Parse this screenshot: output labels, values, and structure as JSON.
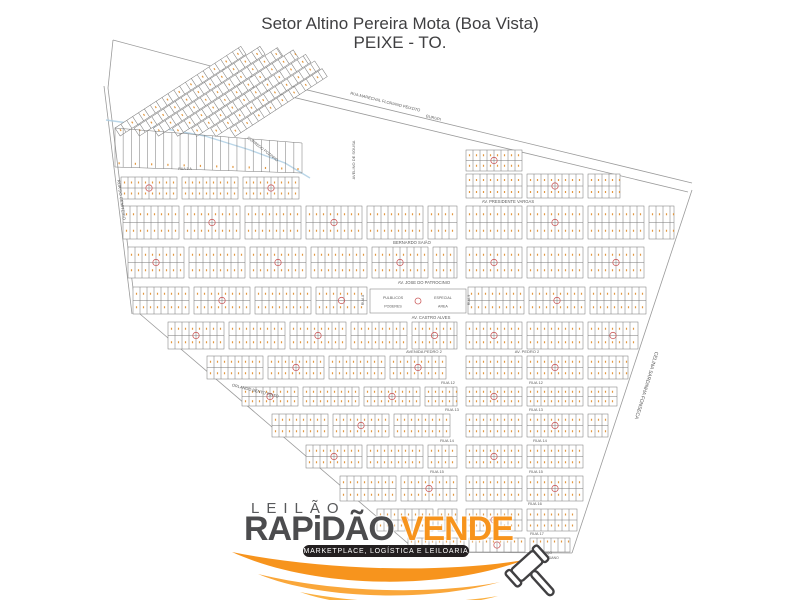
{
  "title": {
    "line1": "Setor Altino Pereira Mota (Boa Vista)",
    "line2": "PEIXE - TO."
  },
  "colors": {
    "brand_orange": "#f7941d",
    "brand_orange_light": "#faa73a",
    "brand_orange_lighter": "#fbb040",
    "brand_dark": "#4c4c4e",
    "pill_bg": "#231f20",
    "map_line": "#767676",
    "boundary_line": "#9a9a9a",
    "lot_number": "#e2973f",
    "block_circle": "#cc5f5f",
    "stream": "#aecfe4",
    "label_text": "#5a5a5a",
    "title_text": "#3f3f41"
  },
  "map": {
    "block_w": 56,
    "street_gap": 5,
    "boundary_lines": [
      [
        [
          113,
          40
        ],
        [
          233,
          72
        ]
      ],
      [
        [
          233,
          72
        ],
        [
          692,
          183
        ]
      ],
      [
        [
          238,
          84
        ],
        [
          688,
          192
        ]
      ],
      [
        [
          113,
          40
        ],
        [
          108,
          88
        ],
        [
          136,
          312
        ]
      ],
      [
        [
          104,
          86
        ],
        [
          132,
          314
        ]
      ],
      [
        [
          140,
          314
        ],
        [
          418,
          552
        ]
      ],
      [
        [
          418,
          552
        ],
        [
          572,
          553
        ]
      ],
      [
        [
          572,
          553
        ],
        [
          692,
          190
        ]
      ]
    ],
    "stream": [
      [
        106,
        120
      ],
      [
        150,
        126
      ],
      [
        205,
        136
      ],
      [
        250,
        150
      ],
      [
        285,
        163
      ],
      [
        310,
        178
      ]
    ],
    "rows": [
      {
        "y": 150,
        "h": 21,
        "spans": [
          [
            466,
            530
          ]
        ]
      },
      {
        "y": 174,
        "h": 24,
        "spans": [
          [
            466,
            620
          ]
        ]
      },
      {
        "y": 177,
        "h": 22,
        "spans": [
          [
            121,
            313
          ]
        ]
      },
      {
        "y": 206,
        "h": 33,
        "spans": [
          [
            123,
            457
          ],
          [
            466,
            674
          ]
        ]
      },
      {
        "y": 247,
        "h": 31,
        "spans": [
          [
            128,
            457
          ],
          [
            466,
            662
          ]
        ]
      },
      {
        "y": 287,
        "h": 27,
        "spans": [
          [
            133,
            367
          ],
          [
            468,
            650
          ]
        ]
      },
      {
        "y": 322,
        "h": 27,
        "spans": [
          [
            168,
            457
          ],
          [
            466,
            638
          ]
        ]
      },
      {
        "y": 356,
        "h": 23,
        "spans": [
          [
            207,
            457
          ],
          [
            466,
            628
          ]
        ]
      },
      {
        "y": 387,
        "h": 19,
        "spans": [
          [
            242,
            457
          ],
          [
            466,
            617
          ]
        ]
      },
      {
        "y": 414,
        "h": 23,
        "spans": [
          [
            272,
            457
          ],
          [
            466,
            608
          ]
        ]
      },
      {
        "y": 445,
        "h": 23,
        "spans": [
          [
            306,
            457
          ],
          [
            466,
            598
          ]
        ]
      },
      {
        "y": 476,
        "h": 25,
        "spans": [
          [
            340,
            457
          ],
          [
            466,
            587
          ]
        ]
      },
      {
        "y": 509,
        "h": 22,
        "spans": [
          [
            377,
            457
          ],
          [
            466,
            577
          ]
        ]
      },
      {
        "y": 538,
        "h": 14,
        "spans": [
          [
            408,
            570
          ]
        ]
      }
    ],
    "diagonal_grid": {
      "transform": "translate(115,128) rotate(-33)",
      "strip_h": 9.5,
      "strips": [
        [
          0,
          0,
          150
        ],
        [
          16,
          10.5,
          150
        ],
        [
          32,
          21,
          148
        ],
        [
          48,
          31.5,
          144
        ],
        [
          64,
          42,
          136
        ],
        [
          80,
          52.5,
          124
        ],
        [
          96,
          63,
          110
        ]
      ]
    },
    "comb": {
      "x1": 115,
      "x2": 302,
      "yt1": 128,
      "yt2": 143,
      "yb1": 167,
      "yb2": 173,
      "step": 8
    },
    "special_block": {
      "x": 370,
      "y": 289,
      "w": 96,
      "h": 24,
      "left_line1": "PULBLICOS",
      "left_line2": "PODERES",
      "right_line1": "ESPECIAL",
      "right_line2": "AREA"
    },
    "street_labels": [
      {
        "t": "RUA MARECHAL FLORIANO PEIXOTO",
        "x": 385,
        "y": 103,
        "r": 14,
        "s": 4
      },
      {
        "t": "GURUPI",
        "x": 433,
        "y": 119,
        "r": 14,
        "s": 4
      },
      {
        "t": "AVELINO DE SOUSA",
        "x": 355,
        "y": 160,
        "r": -90,
        "s": 4
      },
      {
        "t": "CORREGO POZINHO",
        "x": 262,
        "y": 150,
        "r": 38,
        "s": 3.8
      },
      {
        "t": "RUA DO CEMITERIO",
        "x": 120,
        "y": 200,
        "r": 82,
        "s": 4.2
      },
      {
        "t": "RUA 5 A",
        "x": 185,
        "y": 170,
        "r": 0,
        "s": 3.6
      },
      {
        "t": "AV. PRESIDENTE VARGAS",
        "x": 508,
        "y": 203,
        "r": 0,
        "s": 4.2
      },
      {
        "t": "BERNARDO SAIÃO",
        "x": 412,
        "y": 244,
        "r": 0,
        "s": 4.2
      },
      {
        "t": "AV. JOSE DO PATROCINIO",
        "x": 424,
        "y": 284,
        "r": 0,
        "s": 4.2
      },
      {
        "t": "AV. CASTRO ALVES",
        "x": 431,
        "y": 319,
        "r": 0,
        "s": 4.2
      },
      {
        "t": "AVENIDA PEDRO 2",
        "x": 424,
        "y": 353,
        "r": 0,
        "s": 4
      },
      {
        "t": "AV. PEDRO 2",
        "x": 527,
        "y": 353,
        "r": 0,
        "s": 4
      },
      {
        "t": "RUA 12",
        "x": 448,
        "y": 384,
        "r": 0,
        "s": 4
      },
      {
        "t": "RUA 12",
        "x": 536,
        "y": 384,
        "r": 0,
        "s": 4
      },
      {
        "t": "RUA 13",
        "x": 452,
        "y": 411,
        "r": 0,
        "s": 4
      },
      {
        "t": "RUA 13",
        "x": 536,
        "y": 411,
        "r": 0,
        "s": 4
      },
      {
        "t": "RUA 14",
        "x": 447,
        "y": 442,
        "r": 0,
        "s": 4
      },
      {
        "t": "RUA 14",
        "x": 540,
        "y": 442,
        "r": 0,
        "s": 4
      },
      {
        "t": "RUA 15",
        "x": 437,
        "y": 473,
        "r": 0,
        "s": 4
      },
      {
        "t": "RUA 15",
        "x": 536,
        "y": 473,
        "r": 0,
        "s": 4
      },
      {
        "t": "RUA 16",
        "x": 535,
        "y": 505,
        "r": 0,
        "s": 4
      },
      {
        "t": "RUA 17",
        "x": 537,
        "y": 535,
        "r": 0,
        "s": 4
      },
      {
        "t": "RUA 8",
        "x": 364,
        "y": 300,
        "r": -90,
        "s": 3.6
      },
      {
        "t": "RUA 9",
        "x": 470,
        "y": 300,
        "r": -90,
        "s": 3.6
      },
      {
        "t": "ORLANDO BENTO PINTO",
        "x": 255,
        "y": 392,
        "r": 14,
        "s": 4
      },
      {
        "t": "CELINA SARDINHA FONSECA",
        "x": 645,
        "y": 385,
        "r": 107,
        "s": 5
      },
      {
        "t": "POÇO",
        "x": 547,
        "y": 554,
        "r": 0,
        "s": 3.4
      },
      {
        "t": "ARTESIANO",
        "x": 549,
        "y": 559,
        "r": 0,
        "s": 3.4
      }
    ]
  },
  "logo": {
    "leilao": "LEILÃO",
    "brand_dark": "RAPiDÃO",
    "brand_orange": "VENDE",
    "tagline": "MARKETPLACE, LOGÍSTICA E LEILOARIA"
  }
}
